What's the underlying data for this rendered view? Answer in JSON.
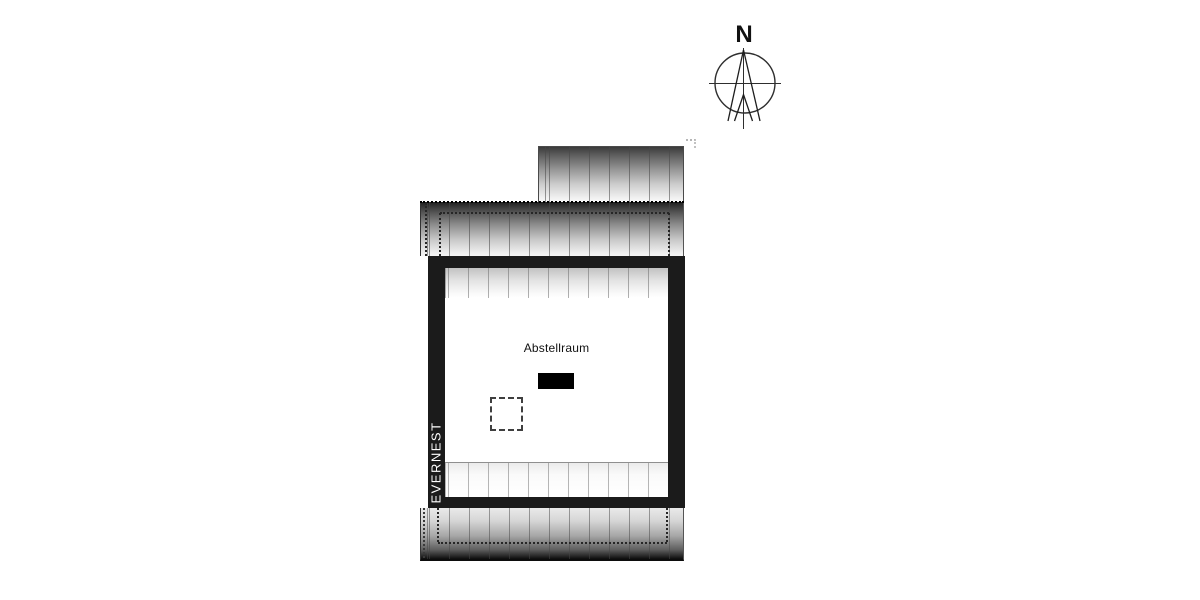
{
  "title": "Attic floor plan",
  "compass": {
    "north_label": "N"
  },
  "plan": {
    "room_label": "Abstellraum",
    "brand_watermark": "EVERNEST"
  },
  "colors": {
    "wall": "#1b1b1b",
    "background": "#ffffff",
    "watermark_text": "#ffffff",
    "chimney_fill": "#000000"
  }
}
